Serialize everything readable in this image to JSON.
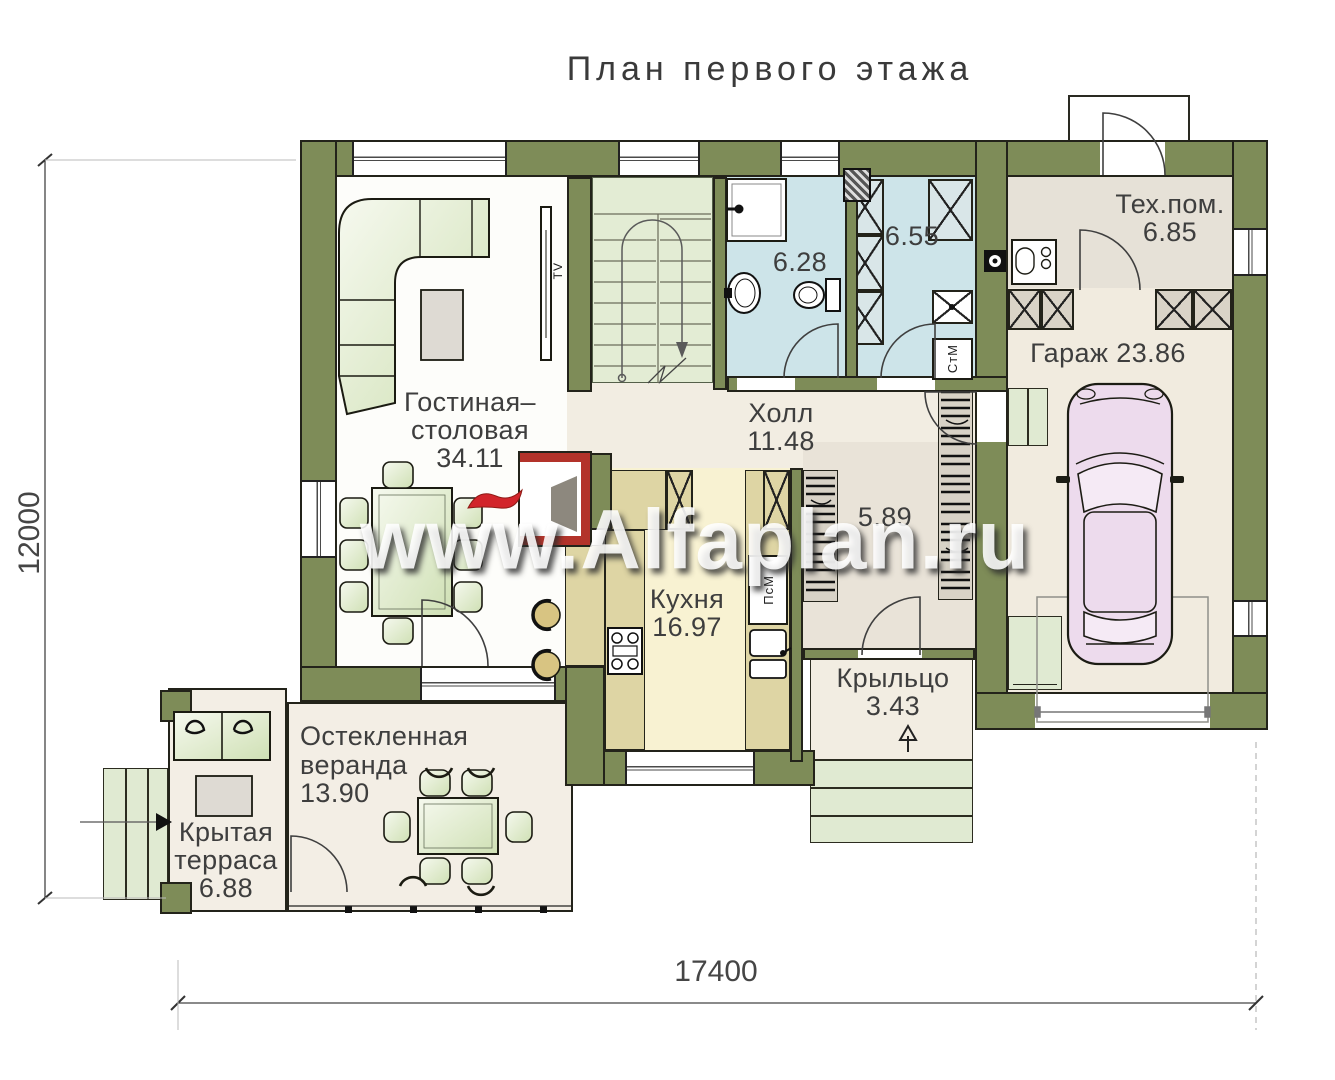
{
  "title": "План первого этажа",
  "watermark": "www.Alfaplan.ru",
  "dimensions": {
    "bottom": "17400",
    "left": "12000"
  },
  "rooms": {
    "living": {
      "name_line1": "Гостиная–",
      "name_line2": "столовая",
      "area": "34.11"
    },
    "hall": {
      "name": "Холл",
      "area": "11.48"
    },
    "kitchen": {
      "name": "Кухня",
      "area": "16.97"
    },
    "bathroom": {
      "area": "6.28"
    },
    "laundry": {
      "area": "6.55"
    },
    "wardrobe": {
      "area": "5.89"
    },
    "tech": {
      "name": "Тех.пом.",
      "area": "6.85"
    },
    "garage": {
      "name": "Гараж",
      "area": "23.86"
    },
    "porch": {
      "name": "Крыльцо",
      "area": "3.43"
    },
    "veranda": {
      "name_line1": "Остекленная",
      "name_line2": "веранда",
      "area": "13.90"
    },
    "terrace": {
      "name_line1": "Крытая",
      "name_line2": "терраса",
      "area": "6.88"
    }
  },
  "labels": {
    "washer": "СтМ",
    "dishwasher": "ПсМ",
    "tv": "TV"
  },
  "colors": {
    "wall": "#7e8c58",
    "bath_floor": "#cde4e9",
    "kitchen_floor": "#f8f2d2",
    "stairs_floor": "#e3ecd4",
    "fireplace": "#b3332a",
    "car": "#eddbed"
  }
}
